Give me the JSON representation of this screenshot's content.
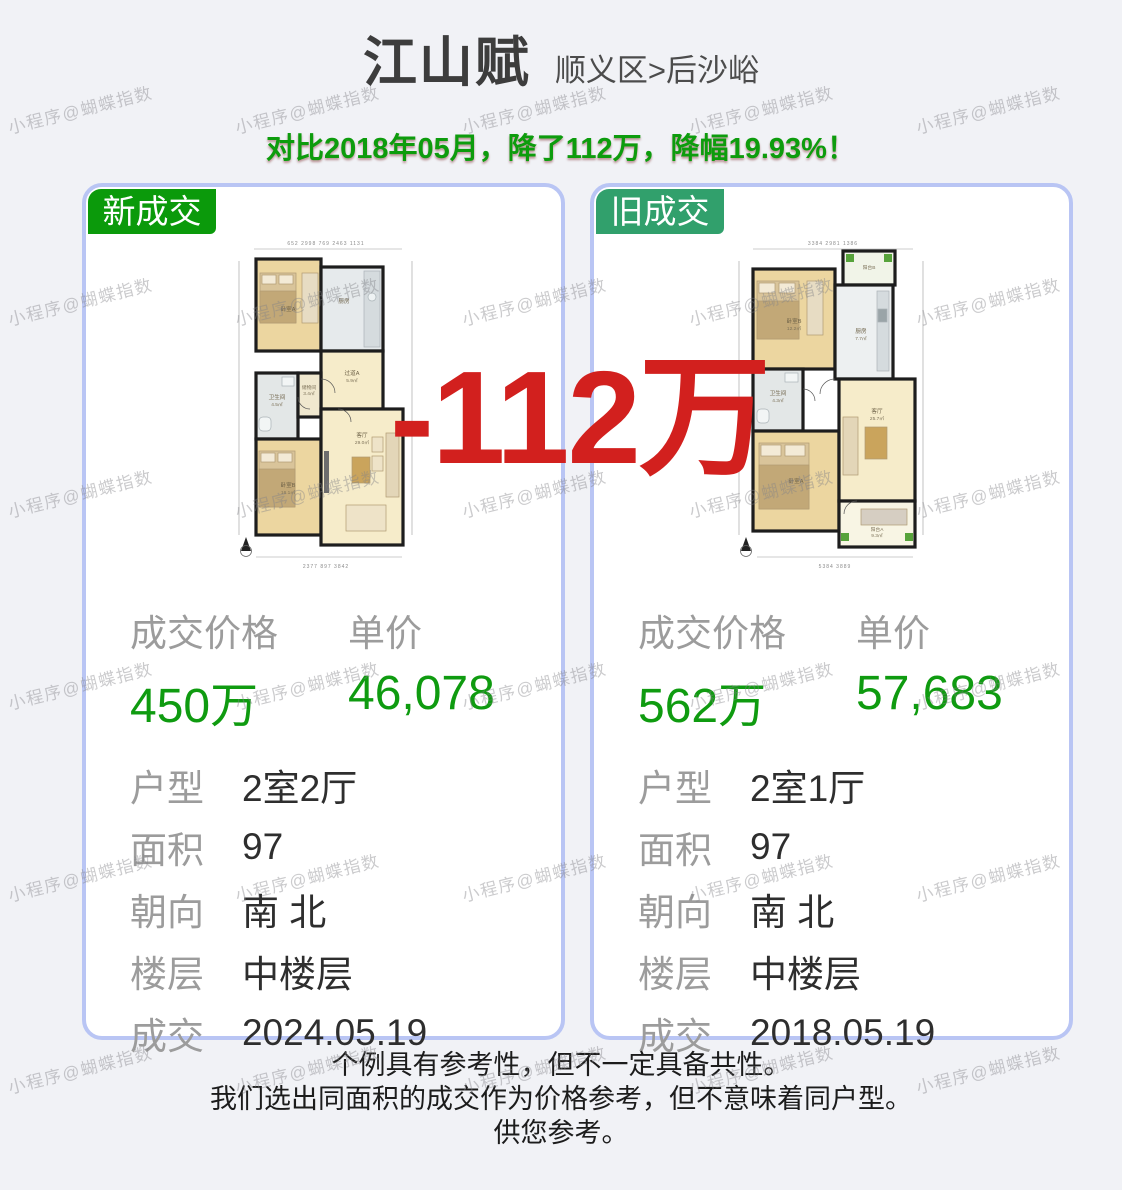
{
  "watermark": {
    "text": "小程序@蝴蝶指数",
    "positions": [
      [
        6,
        96
      ],
      [
        233,
        96
      ],
      [
        460,
        96
      ],
      [
        687,
        96
      ],
      [
        914,
        96
      ],
      [
        6,
        288
      ],
      [
        233,
        288
      ],
      [
        460,
        288
      ],
      [
        687,
        288
      ],
      [
        914,
        288
      ],
      [
        6,
        480
      ],
      [
        233,
        480
      ],
      [
        460,
        480
      ],
      [
        687,
        480
      ],
      [
        914,
        480
      ],
      [
        6,
        672
      ],
      [
        233,
        672
      ],
      [
        460,
        672
      ],
      [
        687,
        672
      ],
      [
        914,
        672
      ],
      [
        6,
        864
      ],
      [
        233,
        864
      ],
      [
        460,
        864
      ],
      [
        687,
        864
      ],
      [
        914,
        864
      ],
      [
        6,
        1056
      ],
      [
        233,
        1056
      ],
      [
        460,
        1056
      ],
      [
        687,
        1056
      ],
      [
        914,
        1056
      ]
    ]
  },
  "header": {
    "title": "江山赋",
    "breadcrumb": "顺义区>后沙峪",
    "announcement": "对比2018年05月，降了112万，降幅19.93%！"
  },
  "overlay": {
    "price_drop": "-112万"
  },
  "cards": [
    {
      "badge": "新成交",
      "price_section": {
        "price_label": "成交价格",
        "unit_label": "单价",
        "price": "450万",
        "unit_price": "46,078"
      },
      "details": [
        {
          "label": "户型",
          "value": "2室2厅"
        },
        {
          "label": "面积",
          "value": "97"
        },
        {
          "label": "朝向",
          "value": "南 北"
        },
        {
          "label": "楼层",
          "value": "中楼层"
        },
        {
          "label": "成交",
          "value": "2024.05.19"
        }
      ],
      "floorplan": {
        "dim_top": "652  2998  769  2463  1131",
        "dim_bottom": "2377  897  3842",
        "rooms": [
          {
            "name": "卧室A",
            "area": ""
          },
          {
            "name": "厨房",
            "area": ""
          },
          {
            "name": "过道A",
            "area": "5.9㎡"
          },
          {
            "name": "卫生间",
            "area": "4.5㎡"
          },
          {
            "name": "储物间",
            "area": "3.4㎡"
          },
          {
            "name": "卧室B",
            "area": "16.1㎡"
          },
          {
            "name": "客厅",
            "area": "29.0㎡"
          }
        ]
      }
    },
    {
      "badge": "旧成交",
      "price_section": {
        "price_label": "成交价格",
        "unit_label": "单价",
        "price": "562万",
        "unit_price": "57,683"
      },
      "details": [
        {
          "label": "户型",
          "value": "2室1厅"
        },
        {
          "label": "面积",
          "value": "97"
        },
        {
          "label": "朝向",
          "value": "南 北"
        },
        {
          "label": "楼层",
          "value": "中楼层"
        },
        {
          "label": "成交",
          "value": "2018.05.19"
        }
      ],
      "floorplan": {
        "dim_top": "3384  2981  1386",
        "dim_bottom": "5384  3889",
        "rooms": [
          {
            "name": "阳台B",
            "area": ""
          },
          {
            "name": "卧室B",
            "area": "12.2㎡"
          },
          {
            "name": "厨房",
            "area": "7.7㎡"
          },
          {
            "name": "卫生间",
            "area": "4.3㎡"
          },
          {
            "name": "卧室A",
            "area": ""
          },
          {
            "name": "客厅",
            "area": "25.7㎡"
          },
          {
            "name": "阳台A",
            "area": "9.3㎡"
          }
        ]
      }
    }
  ],
  "footer": {
    "lines": [
      "个例具有参考性，但不一定具备共性。",
      "我们选出同面积的成交作为价格参考，但不意味着同户型。",
      "供您参考。"
    ]
  },
  "colors": {
    "new_badge_green": "#0b9a0b",
    "old_badge_green": "#31a06c",
    "announcement_green": "#0d9c0d",
    "price_green": "#0f9b10",
    "drop_red": "#d2201e",
    "card_border_blue": "#b9c5f4",
    "background": "#f1f2f6"
  }
}
